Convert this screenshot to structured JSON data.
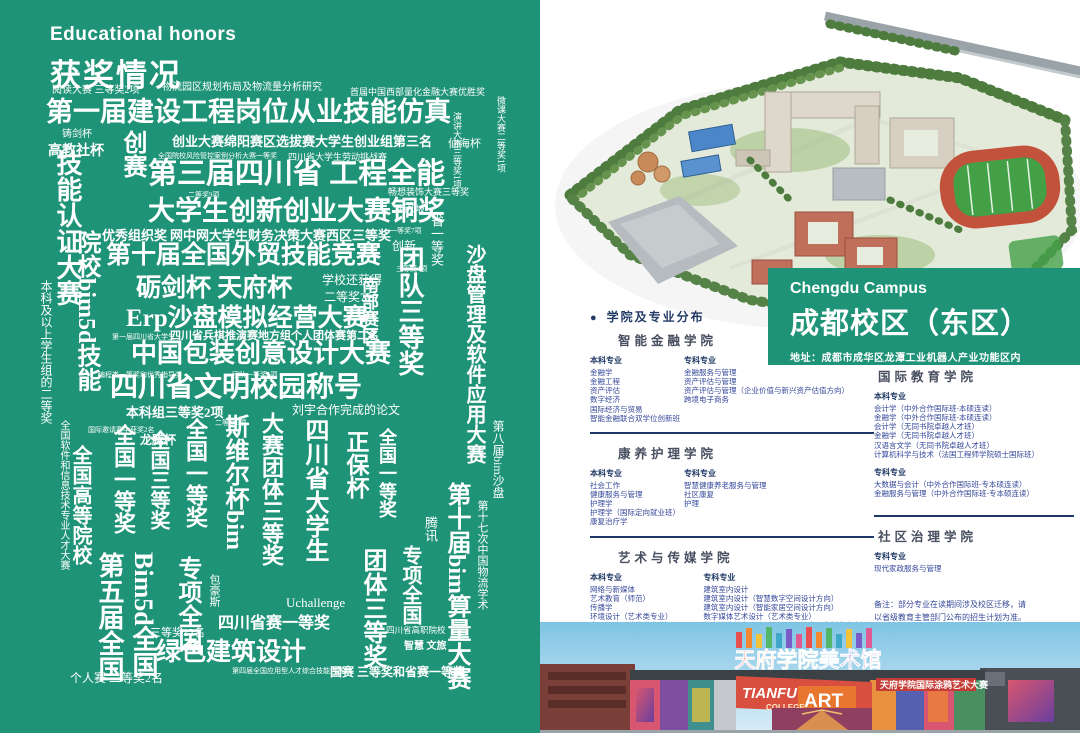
{
  "left_page": {
    "eyebrow": "Educational honors",
    "title": "获奖情况",
    "background_color": "#1F9377",
    "words": [
      {
        "t": "阅读大赛 三等奖2项",
        "x": 52,
        "y": 86,
        "s": 10
      },
      {
        "t": "物流园区规划布局及物流量分析研究",
        "x": 162,
        "y": 83,
        "s": 10
      },
      {
        "t": "首届中国西部量化金融大赛优胜奖",
        "x": 350,
        "y": 88,
        "s": 9
      },
      {
        "t": "第一届建设工程岗位从业技能仿真",
        "x": 46,
        "y": 99,
        "s": 27,
        "w": 700
      },
      {
        "t": "铸剑杯",
        "x": 62,
        "y": 130,
        "s": 10
      },
      {
        "t": "高教社杯",
        "x": 48,
        "y": 145,
        "s": 14,
        "w": 700
      },
      {
        "t": "创业大赛绵阳赛区选拔赛大学生创业组第三名",
        "x": 172,
        "y": 135,
        "s": 13,
        "w": 700
      },
      {
        "t": "仙海杯",
        "x": 448,
        "y": 139,
        "s": 11
      },
      {
        "t": "全国院校风险管控案例分析大赛一等奖",
        "x": 158,
        "y": 153,
        "s": 7
      },
      {
        "t": "四川省大学生劳动挑战赛",
        "x": 288,
        "y": 153,
        "s": 9
      },
      {
        "t": "第三届四川省 工程全能",
        "x": 148,
        "y": 160,
        "s": 29,
        "w": 700
      },
      {
        "t": "二等奖9项",
        "x": 188,
        "y": 192,
        "s": 7
      },
      {
        "t": "畅想装饰大赛三等奖",
        "x": 388,
        "y": 188,
        "s": 9
      },
      {
        "t": "大学生创新创业大赛铜奖",
        "x": 148,
        "y": 198,
        "s": 27,
        "w": 700
      },
      {
        "t": "优秀组织奖",
        "x": 102,
        "y": 229,
        "s": 13,
        "w": 700
      },
      {
        "t": "网中网大学生财务决策大赛西区三等奖",
        "x": 170,
        "y": 229,
        "s": 13,
        "w": 700
      },
      {
        "t": "一等奖7项",
        "x": 390,
        "y": 228,
        "s": 7
      },
      {
        "t": "创新",
        "x": 392,
        "y": 240,
        "s": 12
      },
      {
        "t": "新加坡",
        "x": 398,
        "y": 205,
        "s": 9
      },
      {
        "t": "第十届全国外贸技能竞赛",
        "x": 106,
        "y": 243,
        "s": 25,
        "w": 700
      },
      {
        "t": "三等奖4项",
        "x": 396,
        "y": 266,
        "s": 7
      },
      {
        "t": "砺剑杯 天府杯",
        "x": 136,
        "y": 276,
        "s": 25,
        "w": 700
      },
      {
        "t": "学校还获得",
        "x": 322,
        "y": 274,
        "s": 12
      },
      {
        "t": "二等奖7名",
        "x": 324,
        "y": 291,
        "s": 12
      },
      {
        "t": "Erp沙盘模拟经营大赛",
        "x": 126,
        "y": 306,
        "s": 25,
        "w": 700
      },
      {
        "t": "第一届四川省大学生",
        "x": 112,
        "y": 334,
        "s": 7
      },
      {
        "t": "四川省兵棋推演赛地方组个人团体赛第二名",
        "x": 170,
        "y": 331,
        "s": 11,
        "w": 700
      },
      {
        "t": "中国包装创意设计大赛",
        "x": 131,
        "y": 341,
        "s": 26,
        "w": 700
      },
      {
        "t": "编程类一等奖和优秀指导奖",
        "x": 98,
        "y": 372,
        "s": 7
      },
      {
        "t": "团队一等奖1项",
        "x": 232,
        "y": 372,
        "s": 7
      },
      {
        "t": "四川省文明校园称号",
        "x": 110,
        "y": 374,
        "s": 28,
        "w": 700
      },
      {
        "t": "本科组三等奖2项",
        "x": 126,
        "y": 406,
        "s": 13,
        "w": 700
      },
      {
        "t": "刘宇合作完成的论文",
        "x": 292,
        "y": 404,
        "s": 12
      },
      {
        "t": "国际邀请赛中获奖2名",
        "x": 88,
        "y": 427,
        "s": 7
      },
      {
        "t": "二等奖6项",
        "x": 215,
        "y": 420,
        "s": 7
      },
      {
        "t": "龙腾杯",
        "x": 140,
        "y": 434,
        "s": 12,
        "w": 700
      },
      {
        "t": "技能认证大赛",
        "x": 54,
        "y": 150,
        "s": 26,
        "w": 700,
        "v": 1
      },
      {
        "t": "创赛",
        "x": 120,
        "y": 130,
        "s": 24,
        "w": 700,
        "v": 1
      },
      {
        "t": "演讲大赛三等奖1项",
        "x": 452,
        "y": 112,
        "s": 9,
        "v": 1
      },
      {
        "t": "微课大赛二等奖1项",
        "x": 496,
        "y": 96,
        "s": 9,
        "v": 1
      },
      {
        "t": "本科及以上学生组的二等奖",
        "x": 40,
        "y": 280,
        "s": 12,
        "v": 1
      },
      {
        "t": "院校bim5d技能",
        "x": 74,
        "y": 230,
        "s": 24,
        "w": 700,
        "v": 1
      },
      {
        "t": "省一等奖",
        "x": 430,
        "y": 214,
        "s": 13,
        "v": 1
      },
      {
        "t": "团队三等奖",
        "x": 396,
        "y": 246,
        "s": 26,
        "w": 700,
        "v": 1
      },
      {
        "t": "南部赛区",
        "x": 360,
        "y": 276,
        "s": 17,
        "w": 700,
        "v": 1
      },
      {
        "t": "沙盘管理及软件应用大赛",
        "x": 464,
        "y": 244,
        "s": 20,
        "w": 700,
        "v": 1
      },
      {
        "t": "腾讯",
        "x": 424,
        "y": 516,
        "s": 13,
        "v": 1
      },
      {
        "t": "全国软件和信息技术专业人才大赛",
        "x": 58,
        "y": 420,
        "s": 10,
        "v": 1
      },
      {
        "t": "全国高等院校",
        "x": 70,
        "y": 445,
        "s": 20,
        "w": 700,
        "v": 1
      },
      {
        "t": "全国一等奖",
        "x": 112,
        "y": 424,
        "s": 22,
        "w": 700,
        "v": 1
      },
      {
        "t": "全国三等奖",
        "x": 148,
        "y": 430,
        "s": 20,
        "w": 700,
        "v": 1
      },
      {
        "t": "全国一等奖",
        "x": 184,
        "y": 418,
        "s": 22,
        "w": 700,
        "v": 1
      },
      {
        "t": "斯维尔杯bim",
        "x": 222,
        "y": 414,
        "s": 24,
        "w": 700,
        "v": 1
      },
      {
        "t": "大赛团体三等奖",
        "x": 260,
        "y": 412,
        "s": 22,
        "w": 700,
        "v": 1
      },
      {
        "t": "四川省大学生",
        "x": 302,
        "y": 418,
        "s": 24,
        "w": 700,
        "v": 1
      },
      {
        "t": "正保杯",
        "x": 344,
        "y": 430,
        "s": 23,
        "w": 700,
        "v": 1
      },
      {
        "t": "全国一等奖",
        "x": 378,
        "y": 428,
        "s": 18,
        "w": 700,
        "v": 1
      },
      {
        "t": "第十七次中国物流学术",
        "x": 476,
        "y": 500,
        "s": 11,
        "v": 1
      },
      {
        "t": "第八届bim沙盘",
        "x": 492,
        "y": 420,
        "s": 12,
        "v": 1
      },
      {
        "t": "第五届全国",
        "x": 96,
        "y": 552,
        "s": 26,
        "w": 700,
        "v": 1
      },
      {
        "t": "Bim5d全国",
        "x": 130,
        "y": 552,
        "s": 26,
        "w": 700,
        "v": 1
      },
      {
        "t": "专项全国",
        "x": 175,
        "y": 556,
        "s": 24,
        "w": 700,
        "v": 1
      },
      {
        "t": "包豪斯",
        "x": 208,
        "y": 574,
        "s": 11,
        "v": 1
      },
      {
        "t": "团体三等奖",
        "x": 360,
        "y": 548,
        "s": 24,
        "w": 700,
        "v": 1
      },
      {
        "t": "专项全国",
        "x": 400,
        "y": 545,
        "s": 20,
        "w": 700,
        "v": 1
      },
      {
        "t": "第十届bim算量大赛",
        "x": 444,
        "y": 482,
        "s": 24,
        "w": 700,
        "v": 1
      },
      {
        "t": "三等奖12名",
        "x": 150,
        "y": 628,
        "s": 11
      },
      {
        "t": "四川省赛一等奖",
        "x": 218,
        "y": 616,
        "s": 16,
        "w": 700
      },
      {
        "t": "Uchallenge",
        "x": 286,
        "y": 596,
        "s": 13
      },
      {
        "t": "四川省高职院校",
        "x": 386,
        "y": 626,
        "s": 8.5
      },
      {
        "t": "智慧 文旅",
        "x": 404,
        "y": 642,
        "s": 10,
        "w": 700
      },
      {
        "t": "绿色建筑设计",
        "x": 156,
        "y": 640,
        "s": 25,
        "w": 700
      },
      {
        "t": "个人赛 二等奖2名",
        "x": 70,
        "y": 672,
        "s": 12
      },
      {
        "t": "第四届全国应用型人才综合技能大赛",
        "x": 232,
        "y": 668,
        "s": 7
      },
      {
        "t": "国赛 三等奖和省赛一等奖",
        "x": 330,
        "y": 666,
        "s": 12,
        "w": 700
      }
    ]
  },
  "right_page": {
    "campus_banner": {
      "en": "Chengdu Campus",
      "zh": "成都校区（东区）",
      "address": "地址：成都市成华区龙潭工业机器人产业功能区内",
      "color": "#1F9377"
    },
    "section_header": "学院及专业分布",
    "colleges": [
      {
        "name": "智能金融学院",
        "column": "left",
        "layout": "row",
        "col1": 88,
        "divider": true,
        "columns": [
          {
            "label": "本科专业",
            "items": [
              "金融学",
              "金融工程",
              "资产评估",
              "数字经济",
              "国际经济与贸易",
              "智能金融联合双学位创新班"
            ]
          },
          {
            "label": "专科专业",
            "items": [
              "金融服务与管理",
              "资产评估与管理",
              "资产评估与管理（企业价值与新兴资产估值方向）",
              "跨境电子商务"
            ]
          }
        ]
      },
      {
        "name": "康养护理学院",
        "column": "left",
        "layout": "row",
        "col1": 88,
        "divider": true,
        "columns": [
          {
            "label": "本科专业",
            "items": [
              "社会工作",
              "健康服务与管理",
              "护理学",
              "护理学（国际定向就业班）",
              "康复治疗学"
            ]
          },
          {
            "label": "专科专业",
            "items": [
              "智慧健康养老服务与管理",
              "社区康复",
              "护理"
            ]
          }
        ]
      },
      {
        "name": "艺术与传媒学院",
        "column": "left",
        "layout": "row",
        "col1": 122,
        "divider": false,
        "columns": [
          {
            "label": "本科专业",
            "items": [
              "网络与新媒体",
              "艺术教育（师范）",
              "传播学",
              "环境设计（艺术类专业）",
              "产品设计（艺术类专业）",
              "视觉传达设计（艺术类专业）",
              "数字媒体艺术（艺术类专业）"
            ]
          },
          {
            "label": "专科专业",
            "items": [
              "建筑室内设计",
              "建筑室内设计（智慧数字空间设计方向）",
              "建筑室内设计（智能家居空间设计方向）",
              "数字媒体艺术设计（艺术类专业）",
              "数字媒体艺术设计（AI绘画与数字影像制作方向）",
              "数字媒体艺术设计（动漫创意与制作方向）",
              "融媒体技术与运营",
              "动漫制作技术",
              "网络新闻与传播"
            ]
          }
        ]
      },
      {
        "name": "国际教育学院",
        "column": "right",
        "layout": "stack",
        "divider": true,
        "columns": [
          {
            "label": "本科专业",
            "items": [
              "会计学（中外合作国际班-本硕连读）",
              "金融学（中外合作国际班-本硕连读）",
              "会计学（无同书院卓越人才班）",
              "金融学（无同书院卓越人才班）",
              "汉语言文学（无同书院卓越人才班）",
              "计算机科学与技术（法国工程师学院硕士国际班）"
            ]
          },
          {
            "label": "专科专业",
            "items": [
              "大数据与会计（中外合作国际班-专本硕连读）",
              "金融服务与管理（中外合作国际班-专本硕连读）"
            ]
          }
        ]
      },
      {
        "name": "社区治理学院",
        "column": "right",
        "layout": "stack",
        "divider": false,
        "columns": [
          {
            "label": "专科专业",
            "items": [
              "现代家政服务与管理"
            ]
          }
        ]
      }
    ],
    "note_lines": [
      "备注：部分专业在读期间涉及校区迁移，请",
      "以省级教育主管部门公布的招生计划为准。"
    ],
    "photo": {
      "rooftop_sign": "天府学院美术馆",
      "banner_line1": "TIANFU",
      "banner_line2": "COLLEGE",
      "banner_line3": "ART",
      "banner_zh": "天府学院国际涂鸦艺术大赛"
    }
  }
}
